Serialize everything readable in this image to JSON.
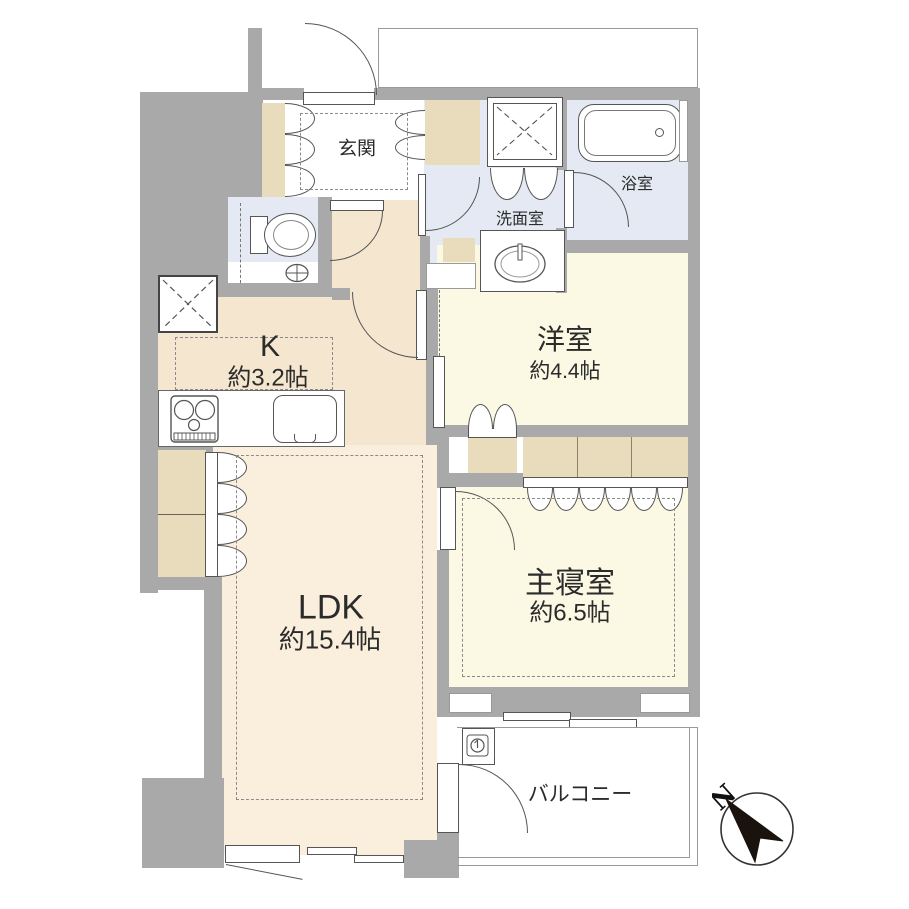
{
  "plan": {
    "type": "apartment-floor-plan",
    "rooms": {
      "genkan": {
        "label": "玄関"
      },
      "washroom": {
        "label": "洗面室"
      },
      "bathroom": {
        "label": "浴室"
      },
      "western": {
        "label": "洋室",
        "size": "約4.4帖"
      },
      "kitchen": {
        "label": "K",
        "size": "約3.2帖"
      },
      "ldk": {
        "label": "LDK",
        "size": "約15.4帖"
      },
      "bedroom": {
        "label": "主寝室",
        "size": "約6.5帖"
      },
      "balcony": {
        "label": "バルコニー"
      }
    },
    "compass": {
      "north_label": "N"
    },
    "colors": {
      "wall": "#a9a9a9",
      "floor_hall_kitchen": "#f5e7cf",
      "floor_ldk": "#faeedc",
      "floor_rooms": "#fbf8e3",
      "floor_wet_areas": "#e4e9f4",
      "closet": "#e8dcbc",
      "outline": "#555555",
      "compass_arrow": "#1a120c"
    }
  }
}
